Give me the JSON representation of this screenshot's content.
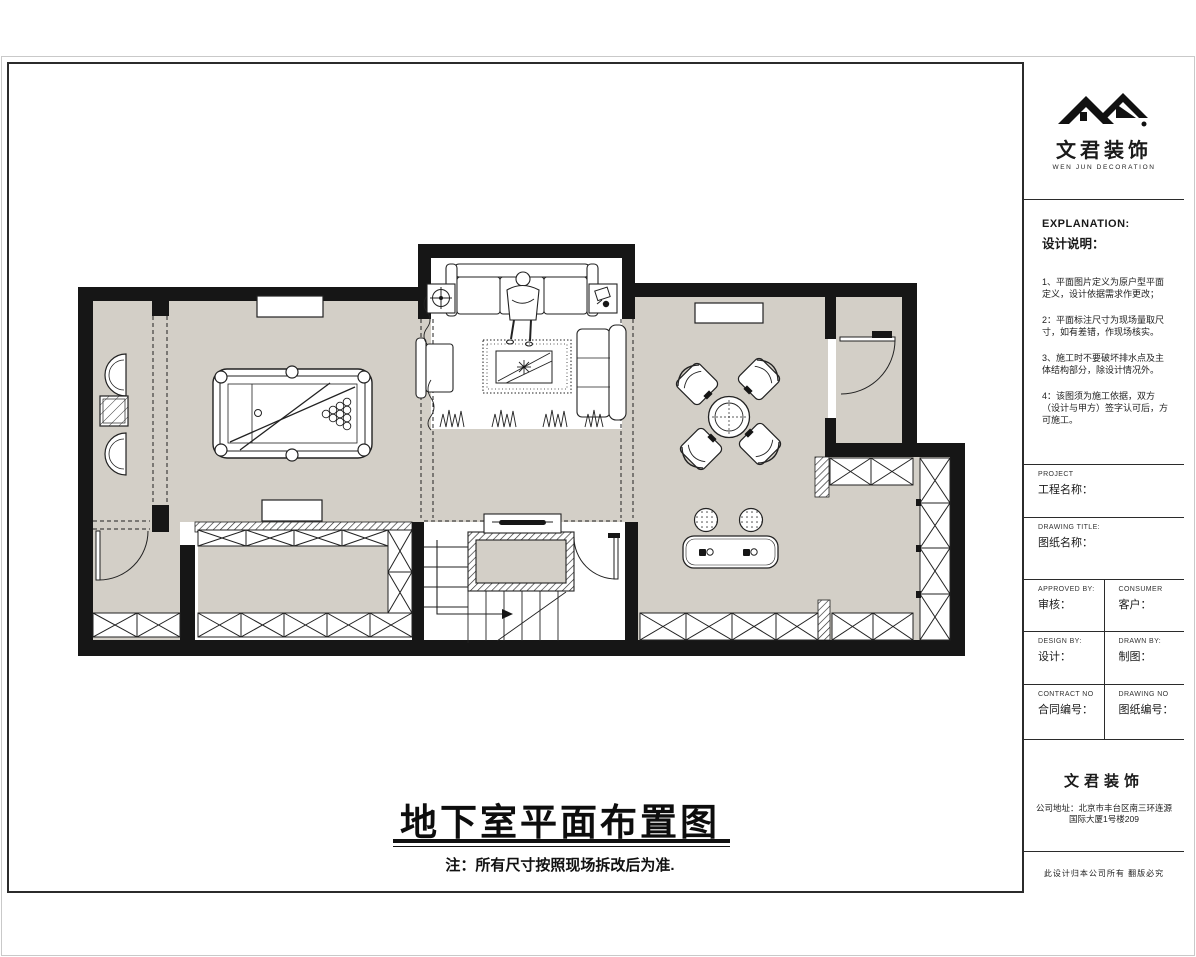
{
  "titleblock": {
    "title": "地下室平面布置图",
    "note": "注：所有尺寸按照现场拆改后为准."
  },
  "sidebar": {
    "logo": {
      "name": "文君装饰",
      "subtitle": "WEN JUN DECORATION"
    },
    "explanation": {
      "label_en": "EXPLANATION:",
      "label_zh": "设计说明：",
      "notes": [
        "1、平面图片定义为原户型平面定义，设计依据需求作更改；",
        "2：平面标注尺寸为现场量取尺寸，如有差错，作现场核实。",
        "3、施工时不要破坏排水点及主体结构部分，除设计情况外。",
        "4：该图须为施工依据，双方（设计与甲方）签字认可后，方可施工。"
      ]
    },
    "fields": {
      "project": {
        "en": "PROJECT",
        "zh": "工程名称："
      },
      "drawing_title": {
        "en": "DRAWING TITLE:",
        "zh": "图纸名称："
      },
      "approved": {
        "en": "APPROVED BY:",
        "zh": "审核："
      },
      "consumer": {
        "en": "CONSUMER",
        "zh": "客户："
      },
      "design": {
        "en": "DESIGN BY:",
        "zh": "设计："
      },
      "drawn": {
        "en": "DRAWN BY:",
        "zh": "制图："
      },
      "contract_no": {
        "en": "CONTRACT NO",
        "zh": "合同编号："
      },
      "drawing_no": {
        "en": "DRAWING NO",
        "zh": "图纸编号："
      }
    },
    "company": {
      "name": "文君装饰",
      "address_line1": "公司地址：北京市丰台区南三环连源",
      "address_line2": "国际大厦1号楼209",
      "copyright": "此设计归本公司所有 翻版必究"
    }
  },
  "plan": {
    "colors": {
      "floor": "#d3cfc7",
      "wall": "#161616",
      "paper": "#ffffff"
    }
  }
}
